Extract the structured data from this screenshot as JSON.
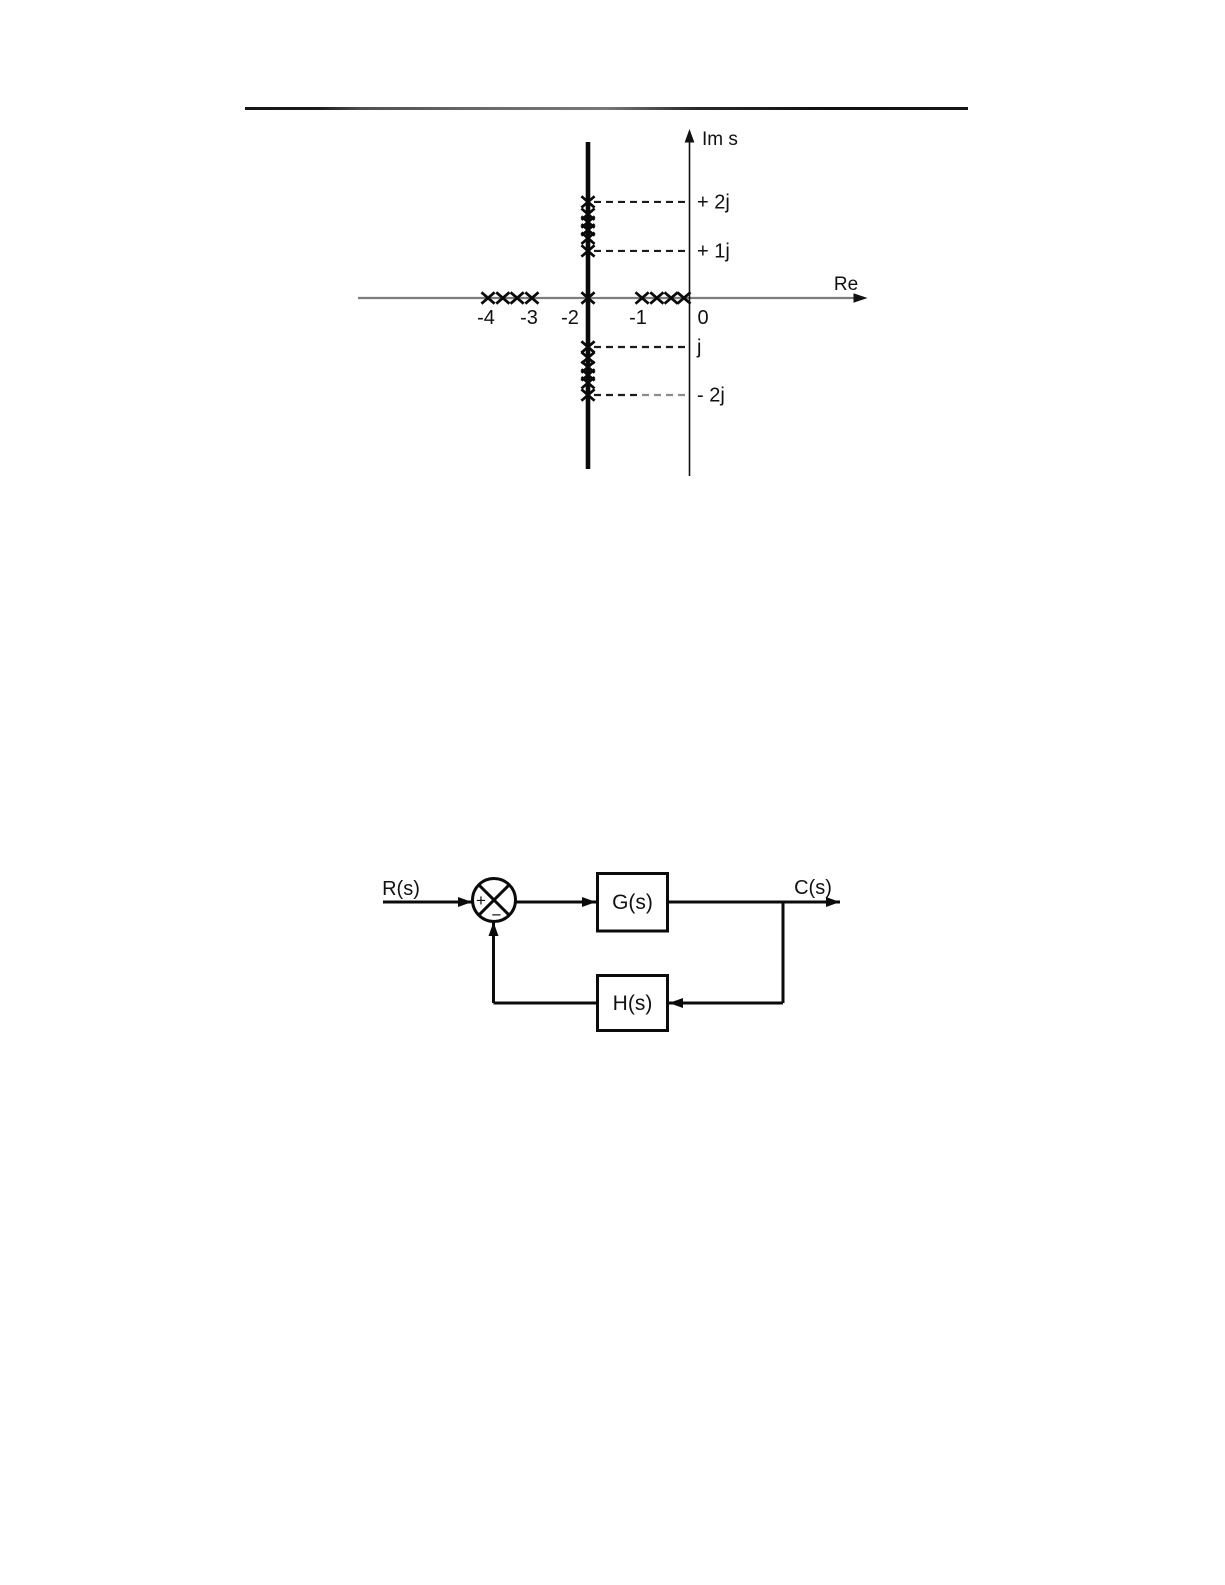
{
  "chart_data": {
    "type": "scatter",
    "xlabel": "Re",
    "ylabel": "Im s",
    "marker": "x",
    "x_tick_labels": [
      "-4",
      "-3",
      "-2",
      "-1",
      "0"
    ],
    "x_tick_values": [
      -4,
      -3,
      -2,
      -1,
      0
    ],
    "vertical_line_re": -2,
    "xlim": [
      -6.5,
      3.4
    ],
    "ylim": [
      -3.6,
      3.4
    ],
    "grid": false,
    "guides": [
      {
        "im": 1.96,
        "label": "+ 2j"
      },
      {
        "im": 0.96,
        "label": "+ 1j"
      },
      {
        "im": -1.0,
        "label": "j"
      },
      {
        "im": -1.98,
        "label": "- 2j",
        "faded_right": true
      }
    ],
    "series": [
      {
        "name": "poles-on-real-axis",
        "points": [
          [
            -3.96,
            0
          ],
          [
            -3.67,
            0
          ],
          [
            -3.39,
            0
          ],
          [
            -3.1,
            0
          ],
          [
            -2.0,
            0
          ],
          [
            -0.94,
            0
          ],
          [
            -0.65,
            0
          ],
          [
            -0.37,
            0
          ],
          [
            -0.12,
            0
          ]
        ]
      },
      {
        "name": "poles-on-line-re-minus-2",
        "points": [
          [
            -2,
            1.96
          ],
          [
            -2,
            1.71
          ],
          [
            -2,
            1.55
          ],
          [
            -2,
            1.39
          ],
          [
            -2,
            1.22
          ],
          [
            -2,
            0.96
          ],
          [
            -2,
            -1.0
          ],
          [
            -2,
            -1.22
          ],
          [
            -2,
            -1.41
          ],
          [
            -2,
            -1.57
          ],
          [
            -2,
            -1.73
          ],
          [
            -2,
            -1.98
          ]
        ]
      }
    ]
  },
  "block_diagram": {
    "input_label": "R(s)",
    "output_label": "C(s)",
    "forward_block_label": "G(s)",
    "feedback_block_label": "H(s)",
    "summing_plus": "+",
    "summing_minus": "−"
  }
}
